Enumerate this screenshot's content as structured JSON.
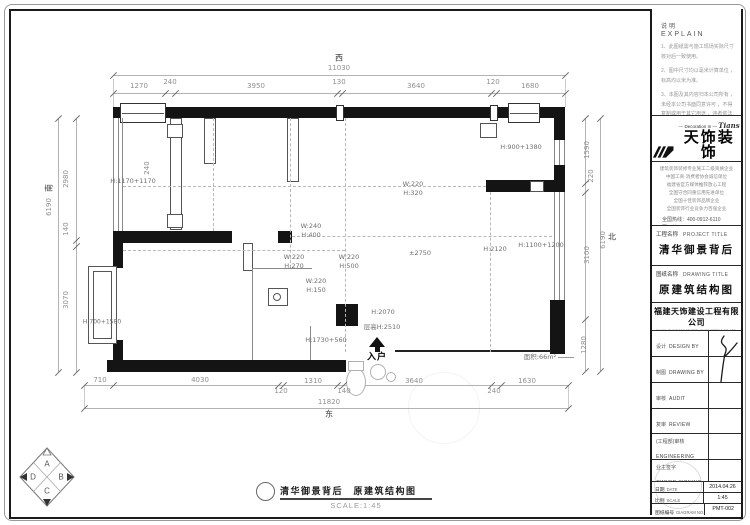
{
  "colors": {
    "wall": "#141414",
    "dim_text": "#8f8f8f",
    "annotation": "#6e6e6e",
    "paper": "#ffffff"
  },
  "explain": {
    "title_cn": "说明",
    "title_en": "EXPLAIN",
    "notes": [
      "1、此图纸需与施工现场实际尺寸 核对后一致使用。",
      "2、图中尺寸均以毫米计算单位 ，标高均以米为准。",
      "3、本图及其内容归本公司所有 ，未经本公司书面同意许可 ，不得复制或用于其它用途 ，违者依法追究责任。"
    ]
  },
  "brand": {
    "deco_line": "— Decoration In —",
    "logo_script": "Tians",
    "logo_cn": "天饰装饰",
    "slogan": "—— 事 事 饰 空 间 · 饰 人 生 ——",
    "credentials": [
      "建筑装饰装修专业施工二级资质企业",
      "中国工商·消费者协会诚信单位",
      "福建省官方媒体推荐放心工程",
      "全国守合同重信用先进单位",
      "全国十佳装饰品牌企业",
      "全国装饰行业竞争力百强企业"
    ],
    "contacts": [
      "全国热线：400-0912-6110",
      "网　址：www.fj-tians.com",
      "天猫QQ：2844325243"
    ]
  },
  "project": {
    "label_cn": "工程名称",
    "label_en": "PROJECT TITLE",
    "value": "清华御景背后"
  },
  "drawing": {
    "label_cn": "图纸名称",
    "label_en": "DRAWING TITLE",
    "value": "原建筑结构图"
  },
  "company": {
    "name": "福建天饰建设工程有限公司",
    "name_en": "FUJIAN TIANS DECORATION ENGINEERING CO.,LTD.",
    "tagline": "—— 缔造天地 · 冶装饰业 ——"
  },
  "signoff": {
    "rows": [
      {
        "cn": "设计",
        "en": "DESIGN BY",
        "stack": false
      },
      {
        "cn": "制图",
        "en": "DRAWING BY",
        "stack": false
      },
      {
        "cn": "审核",
        "en": "AUDIT",
        "stack": false
      },
      {
        "cn": "复审",
        "en": "REVIEW",
        "stack": false
      },
      {
        "cn": "(工程部)审核",
        "en": "ENGINEERING",
        "stack": true
      },
      {
        "cn": "业主签字",
        "en": "OWNER SIGNING",
        "stack": true
      }
    ]
  },
  "meta": {
    "rows": [
      {
        "cn": "日期",
        "en": "DATE",
        "value": "2014.04.26"
      },
      {
        "cn": "比例",
        "en": "SCALE",
        "value": "1:45"
      },
      {
        "cn": "图纸编号",
        "en": "DIAGRAM NO.",
        "value": "PMT-002"
      }
    ]
  },
  "footer": {
    "title": "清华御景背后　原建筑结构图",
    "scale": "SCALE:1:45"
  },
  "compass": {
    "a": "A",
    "b": "B",
    "c": "C",
    "d": "D"
  },
  "plan": {
    "orientation": {
      "top": "西",
      "bottom": "东",
      "left": "南",
      "right": "北"
    },
    "overall_top": "11030",
    "overall_bottom": "11820",
    "overall_left": "6190",
    "overall_right": "6190",
    "dims_top": [
      "1270",
      "240",
      "3950",
      "130",
      "3640",
      "120",
      "1680"
    ],
    "dims_bottom": [
      "710",
      "4030",
      "120",
      "1310",
      "140",
      "3640",
      "240",
      "1630"
    ],
    "dims_left": [
      "2980",
      "140",
      "3070"
    ],
    "dims_right": [
      "1590",
      "220",
      "3100",
      "1280"
    ],
    "area_label": "面积:66m²",
    "floor_height": "层高H:2510",
    "entry_label": "入户",
    "texts": [
      {
        "t": "西",
        "x": 339,
        "y": 58,
        "s": 8,
        "c": "dark"
      },
      {
        "t": "11030",
        "x": 339,
        "y": 68
      },
      {
        "t": "1270",
        "x": 139,
        "y": 86
      },
      {
        "t": "240",
        "x": 170,
        "y": 82
      },
      {
        "t": "3950",
        "x": 256,
        "y": 86
      },
      {
        "t": "130",
        "x": 339,
        "y": 82
      },
      {
        "t": "3640",
        "x": 416,
        "y": 86
      },
      {
        "t": "120",
        "x": 493,
        "y": 82
      },
      {
        "t": "1680",
        "x": 530,
        "y": 86
      },
      {
        "t": "710",
        "x": 100,
        "y": 380
      },
      {
        "t": "4030",
        "x": 200,
        "y": 380
      },
      {
        "t": "120",
        "x": 281,
        "y": 391
      },
      {
        "t": "1310",
        "x": 313,
        "y": 381
      },
      {
        "t": "140",
        "x": 344,
        "y": 391
      },
      {
        "t": "3640",
        "x": 414,
        "y": 381
      },
      {
        "t": "240",
        "x": 494,
        "y": 391
      },
      {
        "t": "1630",
        "x": 527,
        "y": 381
      },
      {
        "t": "11820",
        "x": 329,
        "y": 402
      },
      {
        "t": "东",
        "x": 329,
        "y": 414,
        "s": 8,
        "c": "dark"
      },
      {
        "t": "2980",
        "x": 66,
        "y": 179,
        "r": -90
      },
      {
        "t": "140",
        "x": 66,
        "y": 229,
        "r": -90
      },
      {
        "t": "3070",
        "x": 66,
        "y": 300,
        "r": -90
      },
      {
        "t": "6190",
        "x": 49,
        "y": 207,
        "r": -90
      },
      {
        "t": "南",
        "x": 49,
        "y": 188,
        "r": -90,
        "s": 8,
        "c": "dark"
      },
      {
        "t": "1590",
        "x": 587,
        "y": 150,
        "r": -90
      },
      {
        "t": "220",
        "x": 591,
        "y": 176,
        "r": -90
      },
      {
        "t": "3100",
        "x": 587,
        "y": 255,
        "r": -90
      },
      {
        "t": "1280",
        "x": 584,
        "y": 345,
        "r": -90
      },
      {
        "t": "6190",
        "x": 603,
        "y": 240,
        "r": -90
      },
      {
        "t": "北",
        "x": 612,
        "y": 237,
        "s": 8,
        "c": "dark"
      },
      {
        "t": "H:1170+1170",
        "x": 133,
        "y": 181,
        "c": "ann"
      },
      {
        "t": "240",
        "x": 147,
        "y": 168,
        "r": -90
      },
      {
        "t": "H:900+1380",
        "x": 521,
        "y": 147,
        "c": "ann"
      },
      {
        "t": "W:240",
        "x": 311,
        "y": 226,
        "c": "ann"
      },
      {
        "t": "H:400",
        "x": 311,
        "y": 235,
        "c": "ann"
      },
      {
        "t": "W:220",
        "x": 294,
        "y": 257,
        "c": "ann"
      },
      {
        "t": "H:270",
        "x": 294,
        "y": 266,
        "c": "ann"
      },
      {
        "t": "W:220",
        "x": 349,
        "y": 257,
        "c": "ann"
      },
      {
        "t": "H:500",
        "x": 349,
        "y": 266,
        "c": "ann"
      },
      {
        "t": "W:220",
        "x": 316,
        "y": 281,
        "c": "ann"
      },
      {
        "t": "H:150",
        "x": 316,
        "y": 290,
        "c": "ann"
      },
      {
        "t": "W:220",
        "x": 413,
        "y": 184,
        "c": "ann"
      },
      {
        "t": "H:320",
        "x": 413,
        "y": 193,
        "c": "ann"
      },
      {
        "t": "±2750",
        "x": 420,
        "y": 253,
        "c": "ann"
      },
      {
        "t": "H:2120",
        "x": 495,
        "y": 249,
        "c": "ann"
      },
      {
        "t": "H:1100+1200",
        "x": 541,
        "y": 245,
        "c": "ann"
      },
      {
        "t": "H:2070",
        "x": 383,
        "y": 312,
        "c": "ann"
      },
      {
        "t": "层高H:2510",
        "x": 382,
        "y": 326,
        "c": "ann"
      },
      {
        "t": "H:1730+560",
        "x": 326,
        "y": 340,
        "c": "ann"
      },
      {
        "t": "入户",
        "x": 377,
        "y": 356,
        "c": "entry"
      },
      {
        "t": "H:700+1580",
        "x": 102,
        "y": 322,
        "s": 6,
        "c": "ann"
      },
      {
        "t": "面积:66m²",
        "x": 540,
        "y": 356,
        "s": 6.5,
        "c": "ann"
      }
    ]
  }
}
